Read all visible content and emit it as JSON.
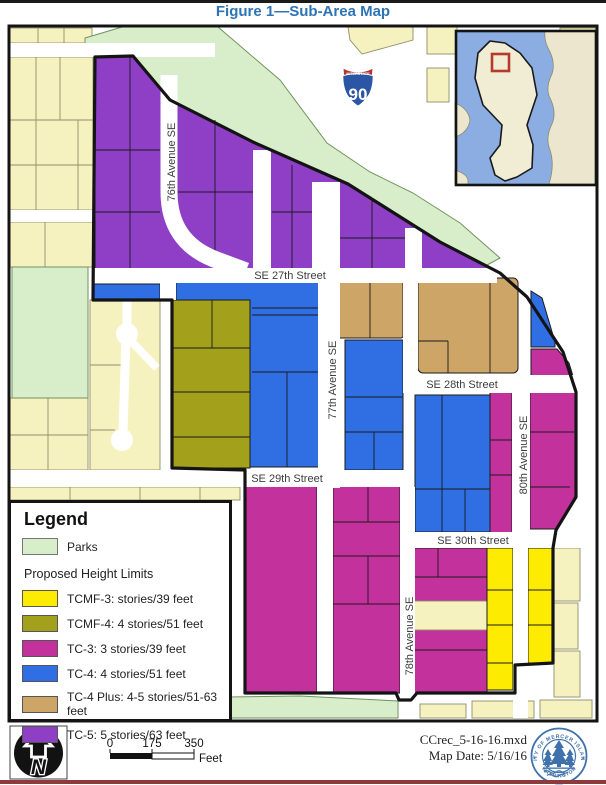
{
  "title": "Figure 1—Sub-Area Map",
  "colors": {
    "tc5": "#8e3fc6",
    "tc4": "#2f6fe3",
    "tc4plus": "#cda566",
    "tc3": "#c2319c",
    "tcmf4": "#a3a01b",
    "tcmf3": "#fdec02",
    "parks": "#d8eecb",
    "parks_border": "#70925c",
    "parcels": "#f6f2bf",
    "parcels_border": "#8f8f68",
    "water": "#8bade2",
    "island": "#f1ecd4",
    "inset_land": "#ece6cf",
    "boundary": "#141414",
    "title_blue": "#2e74b5",
    "locator_red": "#b53a2a",
    "logo_blue": "#3f72ad",
    "street_label": "#3d3d3d",
    "shield_blue": "#2b56a5",
    "shield_red": "#b03436"
  },
  "map": {
    "streets": {
      "se27": "SE 27th Street",
      "se28": "SE 28th Street",
      "se29": "SE 29th Street",
      "se30": "SE 30th Street",
      "ave76": "76th Avenue SE",
      "ave77": "77th Avenue SE",
      "ave78": "78th Avenue SE",
      "ave80": "80th Avenue SE"
    },
    "shield": {
      "label": "INTERSTATE",
      "number": "90"
    }
  },
  "legend": {
    "title": "Legend",
    "parks_label": "Parks",
    "section_title": "Proposed Height Limits",
    "items": [
      {
        "key": "tcmf3",
        "label": "TCMF-3: stories/39 feet"
      },
      {
        "key": "tcmf4",
        "label": "TCMF-4: 4 stories/51 feet"
      },
      {
        "key": "tc3",
        "label": "TC-3: 3 stories/39 feet"
      },
      {
        "key": "tc4",
        "label": "TC-4: 4 stories/51 feet"
      },
      {
        "key": "tc4p",
        "label": "TC-4 Plus: 4-5 stories/51-63 feet"
      },
      {
        "key": "tc5",
        "label": "TC-5: 5 stories/63 feet"
      }
    ]
  },
  "north_arrow": {
    "letter": "N"
  },
  "scale_bar": {
    "ticks": [
      "0",
      "175",
      "350"
    ],
    "unit": "Feet"
  },
  "credits": {
    "line1": "CCrec_5-16-16.mxd",
    "line2": "Map Date: 5/16/16"
  },
  "logo": {
    "text_top": "CITY OF MERCER ISLAND",
    "text_bottom": "WASHINGTON"
  }
}
